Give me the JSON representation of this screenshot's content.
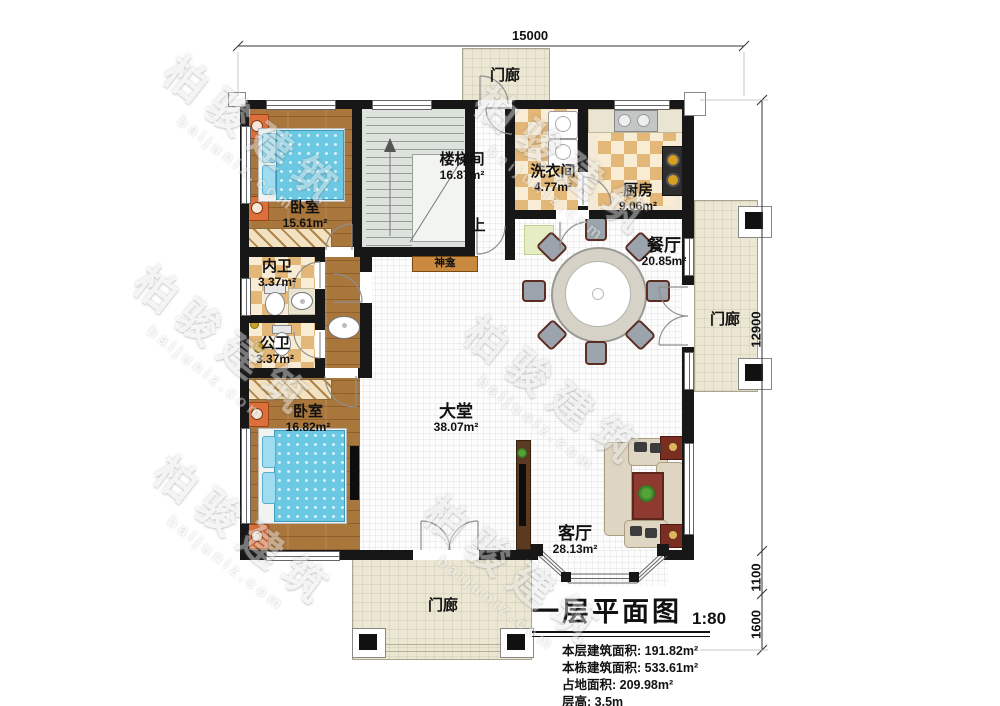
{
  "plan": {
    "dimensions": {
      "top": "15000",
      "right_upper": "12900",
      "right_middle": "1100",
      "right_lower": "1600"
    },
    "porches": {
      "top": "门廊",
      "right": "门廊",
      "bottom": "门廊"
    },
    "rooms": [
      {
        "name": "卧室",
        "area": "15.61m²"
      },
      {
        "name": "楼梯间",
        "area": "16.87m²"
      },
      {
        "name": "洗衣间",
        "area": "4.77m²"
      },
      {
        "name": "厨房",
        "area": "9.06m²"
      },
      {
        "name": "餐厅",
        "area": "20.85m²"
      },
      {
        "name": "内卫",
        "area": "3.37m²"
      },
      {
        "name": "公卫",
        "area": "3.37m²"
      },
      {
        "name": "卧室",
        "area": "16.82m²"
      },
      {
        "name": "大堂",
        "area": "38.07m²"
      },
      {
        "name": "客厅",
        "area": "28.13m²"
      }
    ],
    "annotations": {
      "shrine": "神龛",
      "stairs_up": "上"
    }
  },
  "title_block": {
    "title": "一层平面图",
    "scale": "1:80",
    "stats": [
      {
        "label": "本层建筑面积:",
        "value": "191.82m²"
      },
      {
        "label": "本栋建筑面积:",
        "value": "533.61m²"
      },
      {
        "label": "占地面积:",
        "value": "209.98m²"
      },
      {
        "label": "层高:",
        "value": "3.5m"
      }
    ]
  },
  "watermark": {
    "cn": "柏骏建筑",
    "url": "baijuniz.com"
  },
  "colors": {
    "wall": "#171717",
    "wood_floor": "#a9763c",
    "bed_accent": "#6cc9e4",
    "checker_dark": "#e3b777",
    "checker_light": "#f8ecd4",
    "porch": "#ece7d2"
  }
}
